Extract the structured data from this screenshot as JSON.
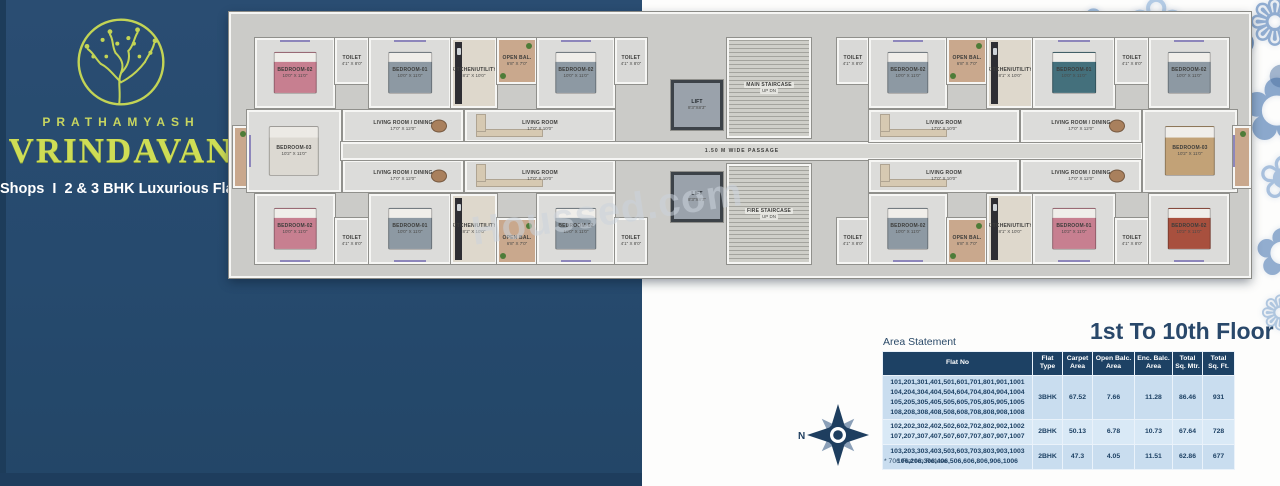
{
  "brand": {
    "name_top": "PRATHAMYASH",
    "name_main": "VRINDAVAN",
    "tagline": "Shops  I  2 & 3 BHK Luxurious Flats"
  },
  "watermark": "Houssed.com",
  "floor_title": "1st To 10th Floor",
  "area_statement": {
    "label": "Area Statement",
    "columns": [
      "Flat No",
      "Flat\nType",
      "Carpet\nArea",
      "Open Balc.\nArea",
      "Enc. Balc.\nArea",
      "Total\nSq. Mtr.",
      "Total\nSq. Ft."
    ],
    "rows": [
      {
        "flats": "101,201,301,401,501,601,701,801,901,1001\n104,204,304,404,504,604,704,804,904,1004\n105,205,305,405,505,605,705,805,905,1005\n108,208,308,408,508,608,708,808,908,1008",
        "type": "3BHK",
        "carpet": "67.52",
        "open_balc": "7.66",
        "enc_balc": "11.28",
        "total_mtr": "86.46",
        "total_ft": "931"
      },
      {
        "flats": "102,202,302,402,502,602,702,802,902,1002\n107,207,307,407,507,607,707,807,907,1007",
        "type": "2BHK",
        "carpet": "50.13",
        "open_balc": "6.78",
        "enc_balc": "10.73",
        "total_mtr": "67.64",
        "total_ft": "728"
      },
      {
        "flats": "103,203,303,403,503,603,703,803,903,1003\n106,206,306,406,506,606,806,906,1006",
        "type": "2BHK",
        "carpet": "47.3",
        "open_balc": "4.05",
        "enc_balc": "11.51",
        "total_mtr": "62.86",
        "total_ft": "677"
      }
    ],
    "footnote": "* 706 Flat No Refuse"
  },
  "compass": {
    "label": "N"
  },
  "colors": {
    "navy_panel": "#264a6e",
    "brand_green": "#cfdd55",
    "table_header": "#1d4164",
    "row_light": "#c9ddef",
    "row_lighter": "#d9e9f6",
    "title_navy": "#29486a",
    "balcony_tan": "#c9a88d",
    "window_purple": "#8d86bb"
  },
  "plan": {
    "passage_label": "1.50 M WIDE PASSAGE",
    "stair_updn": "UP   DN",
    "rooms": [
      {
        "n": "",
        "d": "",
        "x": 2,
        "y": 112,
        "w": 18,
        "h": 62,
        "c": "tan"
      },
      {
        "n": "BEDROOM-02",
        "d": "10'0\" X 11'0\"",
        "x": 24,
        "y": 24,
        "w": 80,
        "h": 70,
        "f": "bed-pink",
        "win": "t"
      },
      {
        "n": "TOILET",
        "d": "4'1\" X 8'0\"",
        "x": 104,
        "y": 24,
        "w": 34,
        "h": 46,
        "c": "toilet"
      },
      {
        "n": "BEDROOM-01",
        "d": "10'0\" X 11'0\"",
        "x": 138,
        "y": 24,
        "w": 82,
        "h": 70,
        "f": "bed-gray",
        "win": "t"
      },
      {
        "n": "KITCHEN/UTILITY",
        "d": "8'1\" X 10'0\"",
        "x": 220,
        "y": 24,
        "w": 46,
        "h": 70,
        "c": "kit",
        "f": "counter"
      },
      {
        "n": "OPEN BAL.",
        "d": "6'8\" X 7'0\"",
        "x": 266,
        "y": 24,
        "w": 40,
        "h": 46,
        "c": "tan"
      },
      {
        "n": "BEDROOM-02",
        "d": "10'0\" X 11'0\"",
        "x": 306,
        "y": 24,
        "w": 78,
        "h": 70,
        "f": "bed-gray",
        "win": "t"
      },
      {
        "n": "TOILET",
        "d": "4'1\" X 8'0\"",
        "x": 384,
        "y": 24,
        "w": 32,
        "h": 46,
        "c": "toilet"
      },
      {
        "n": "BEDROOM-03",
        "d": "10'2\" X 11'0\"",
        "x": 16,
        "y": 96,
        "w": 94,
        "h": 82,
        "f": "bed-white",
        "win": "l"
      },
      {
        "n": "LIVING ROOM / DINING",
        "d": "17'0\" X 12'0\"",
        "x": 112,
        "y": 96,
        "w": 120,
        "h": 32,
        "f": "dining"
      },
      {
        "n": "LIVING ROOM",
        "d": "17'0\" X 10'0\"",
        "x": 234,
        "y": 96,
        "w": 150,
        "h": 32,
        "f": "sofa"
      },
      {
        "n": "LIVING ROOM / DINING",
        "d": "17'0\" X 12'0\"",
        "x": 112,
        "y": 146,
        "w": 120,
        "h": 32,
        "f": "dining"
      },
      {
        "n": "LIVING ROOM",
        "d": "17'0\" X 10'0\"",
        "x": 234,
        "y": 146,
        "w": 150,
        "h": 32,
        "f": "sofa"
      },
      {
        "n": "BEDROOM-02",
        "d": "10'0\" X 11'0\"",
        "x": 24,
        "y": 180,
        "w": 80,
        "h": 70,
        "f": "bed-pink",
        "win": "b"
      },
      {
        "n": "TOILET",
        "d": "4'1\" X 8'0\"",
        "x": 104,
        "y": 204,
        "w": 34,
        "h": 46,
        "c": "toilet"
      },
      {
        "n": "BEDROOM-01",
        "d": "10'0\" X 11'0\"",
        "x": 138,
        "y": 180,
        "w": 82,
        "h": 70,
        "f": "bed-gray",
        "win": "b"
      },
      {
        "n": "KITCHEN/UTILITY",
        "d": "8'1\" X 10'0\"",
        "x": 220,
        "y": 180,
        "w": 46,
        "h": 70,
        "c": "kit",
        "f": "counter"
      },
      {
        "n": "OPEN BAL.",
        "d": "6'8\" X 7'0\"",
        "x": 266,
        "y": 204,
        "w": 40,
        "h": 46,
        "c": "tan"
      },
      {
        "n": "BEDROOM-02",
        "d": "10'0\" X 11'0\"",
        "x": 306,
        "y": 180,
        "w": 78,
        "h": 70,
        "f": "bed-gray",
        "win": "b"
      },
      {
        "n": "TOILET",
        "d": "4'1\" X 8'0\"",
        "x": 384,
        "y": 204,
        "w": 32,
        "h": 46,
        "c": "toilet"
      },
      {
        "n": "LIFT",
        "d": "8'3\"X8'3\"",
        "x": 440,
        "y": 66,
        "w": 52,
        "h": 50,
        "c": "lift"
      },
      {
        "n": "MAIN STAIRCASE",
        "d": "UP   DN",
        "x": 496,
        "y": 24,
        "w": 84,
        "h": 100,
        "c": "stair"
      },
      {
        "n": "LIFT",
        "d": "8'3\"X8'3\"",
        "x": 440,
        "y": 158,
        "w": 52,
        "h": 50,
        "c": "lift"
      },
      {
        "n": "FIRE STAIRCASE",
        "d": "UP   DN",
        "x": 496,
        "y": 150,
        "w": 84,
        "h": 100,
        "c": "stair"
      },
      {
        "n": "1.50 M WIDE PASSAGE",
        "d": "",
        "x": 110,
        "y": 128,
        "w": 802,
        "h": 18,
        "c": "pass"
      },
      {
        "n": "TOILET",
        "d": "4'1\" X 8'0\"",
        "x": 606,
        "y": 24,
        "w": 32,
        "h": 46,
        "c": "toilet"
      },
      {
        "n": "BEDROOM-02",
        "d": "10'0\" X 11'0\"",
        "x": 638,
        "y": 24,
        "w": 78,
        "h": 70,
        "f": "bed-gray",
        "win": "t"
      },
      {
        "n": "OPEN BAL.",
        "d": "6'8\" X 7'0\"",
        "x": 716,
        "y": 24,
        "w": 40,
        "h": 46,
        "c": "tan"
      },
      {
        "n": "KITCHEN/UTILITY",
        "d": "8'1\" X 10'0\"",
        "x": 756,
        "y": 24,
        "w": 46,
        "h": 70,
        "c": "kit",
        "f": "counter"
      },
      {
        "n": "BEDROOM-01",
        "d": "10'0\" X 11'0\"",
        "x": 802,
        "y": 24,
        "w": 82,
        "h": 70,
        "f": "bed-teal",
        "win": "t"
      },
      {
        "n": "TOILET",
        "d": "4'1\" X 8'0\"",
        "x": 884,
        "y": 24,
        "w": 34,
        "h": 46,
        "c": "toilet"
      },
      {
        "n": "BEDROOM-02",
        "d": "10'0\" X 11'0\"",
        "x": 918,
        "y": 24,
        "w": 80,
        "h": 70,
        "f": "bed-gray",
        "win": "t"
      },
      {
        "n": "LIVING ROOM",
        "d": "17'0\" X 10'0\"",
        "x": 638,
        "y": 96,
        "w": 150,
        "h": 32,
        "f": "sofa"
      },
      {
        "n": "LIVING ROOM / DINING",
        "d": "17'0\" X 12'0\"",
        "x": 790,
        "y": 96,
        "w": 120,
        "h": 32,
        "f": "dining"
      },
      {
        "n": "BEDROOM-03",
        "d": "10'2\" X 11'0\"",
        "x": 912,
        "y": 96,
        "w": 94,
        "h": 82,
        "f": "bed-tan",
        "win": "r"
      },
      {
        "n": "LIVING ROOM",
        "d": "17'0\" X 10'0\"",
        "x": 638,
        "y": 146,
        "w": 150,
        "h": 32,
        "f": "sofa"
      },
      {
        "n": "LIVING ROOM / DINING",
        "d": "17'0\" X 12'0\"",
        "x": 790,
        "y": 146,
        "w": 120,
        "h": 32,
        "f": "dining"
      },
      {
        "n": "TOILET",
        "d": "4'1\" X 8'0\"",
        "x": 606,
        "y": 204,
        "w": 32,
        "h": 46,
        "c": "toilet"
      },
      {
        "n": "BEDROOM-02",
        "d": "10'0\" X 11'0\"",
        "x": 638,
        "y": 180,
        "w": 78,
        "h": 70,
        "f": "bed-gray",
        "win": "b"
      },
      {
        "n": "OPEN BAL.",
        "d": "6'8\" X 7'0\"",
        "x": 716,
        "y": 204,
        "w": 40,
        "h": 46,
        "c": "tan"
      },
      {
        "n": "KITCHEN/UTILITY",
        "d": "8'1\" X 10'0\"",
        "x": 756,
        "y": 180,
        "w": 46,
        "h": 70,
        "c": "kit",
        "f": "counter"
      },
      {
        "n": "BEDROOM-01",
        "d": "10'2\" X 11'0\"",
        "x": 802,
        "y": 180,
        "w": 82,
        "h": 70,
        "f": "bed-pink",
        "win": "b"
      },
      {
        "n": "TOILET",
        "d": "4'1\" X 8'0\"",
        "x": 884,
        "y": 204,
        "w": 34,
        "h": 46,
        "c": "toilet"
      },
      {
        "n": "BEDROOM-02",
        "d": "10'2\" X 11'0\"",
        "x": 918,
        "y": 180,
        "w": 80,
        "h": 70,
        "f": "bed-red",
        "win": "b"
      },
      {
        "n": "",
        "d": "",
        "x": 1002,
        "y": 112,
        "w": 18,
        "h": 62,
        "c": "tan"
      }
    ]
  },
  "decor": {
    "flowers": [
      {
        "x": 1070,
        "y": 2,
        "s": 56,
        "g": "✿",
        "c": "#8fb0d6",
        "o": 0.85
      },
      {
        "x": 1126,
        "y": -12,
        "s": 72,
        "g": "❀",
        "c": "#aac5e2",
        "o": 0.9
      },
      {
        "x": 1188,
        "y": 6,
        "s": 84,
        "g": "✿",
        "c": "#5d83b5",
        "o": 0.85
      },
      {
        "x": 1248,
        "y": -8,
        "s": 64,
        "g": "❁",
        "c": "#7e9fc9",
        "o": 0.85
      },
      {
        "x": 1160,
        "y": 52,
        "s": 40,
        "g": "✽",
        "c": "#b9c455",
        "o": 0.9
      },
      {
        "x": 1218,
        "y": 44,
        "s": 30,
        "g": "✽",
        "c": "#c9cf57",
        "o": 0.9
      },
      {
        "x": 1240,
        "y": 66,
        "s": 88,
        "g": "✿",
        "c": "#6f93c1",
        "o": 0.8
      },
      {
        "x": 1258,
        "y": 148,
        "s": 60,
        "g": "❀",
        "c": "#94b2d6",
        "o": 0.8
      },
      {
        "x": 1254,
        "y": 220,
        "s": 66,
        "g": "✿",
        "c": "#6f93c1",
        "o": 0.75
      },
      {
        "x": 1260,
        "y": 290,
        "s": 48,
        "g": "❁",
        "c": "#8fb0d4",
        "o": 0.7
      },
      {
        "x": 1048,
        "y": 48,
        "s": 26,
        "g": "❀",
        "c": "#9db8d9",
        "o": 0.8
      },
      {
        "x": 1102,
        "y": 58,
        "s": 22,
        "g": "●",
        "c": "#c9cf57",
        "o": 0.9
      },
      {
        "x": 1176,
        "y": 96,
        "s": 20,
        "g": "●",
        "c": "#9db8d9",
        "o": 0.9
      },
      {
        "x": 1228,
        "y": 120,
        "s": 24,
        "g": "✽",
        "c": "#b9c455",
        "o": 0.85
      },
      {
        "x": 1268,
        "y": 60,
        "s": 30,
        "g": "●",
        "c": "#4a6fa0",
        "o": 0.5
      },
      {
        "x": 1208,
        "y": 160,
        "s": 34,
        "g": "❀",
        "c": "#a9c3de",
        "o": 0.7
      }
    ]
  }
}
